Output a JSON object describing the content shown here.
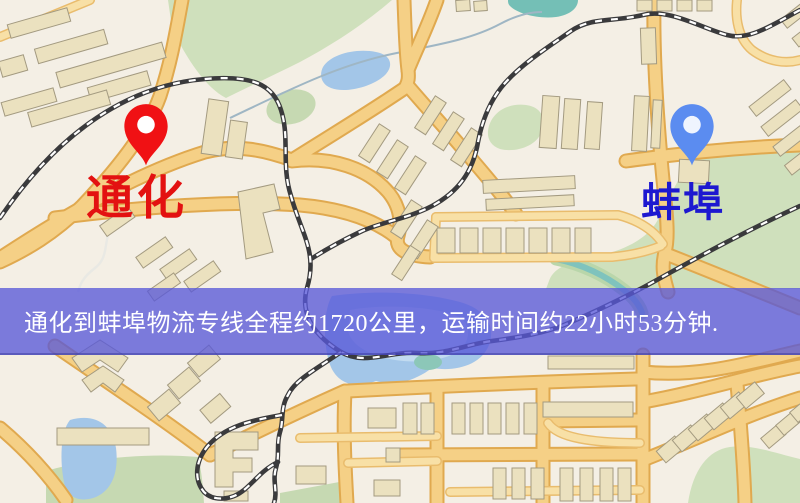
{
  "banner": {
    "text": "通化到蚌埠物流专线全程约1720公里，运输时间约22小时53分钟.",
    "background_color": "#5858d8",
    "text_color": "#ffffff"
  },
  "markers": [
    {
      "id": "origin",
      "city": "通化",
      "pin_color": "#f01114",
      "label_color": "#e31111"
    },
    {
      "id": "destination",
      "city": "蚌埠",
      "pin_color": "#5b8cf0",
      "label_color": "#1d18d0"
    }
  ],
  "route": {
    "origin_city": "通化",
    "destination_city": "蚌埠",
    "distance_text": "约1720公里",
    "duration_text": "约22小时53分钟"
  },
  "map_palette": {
    "background": "#f4efe5",
    "road_fill": "#f5d086",
    "road_edge": "#e0a94f",
    "railway": "#3a3a3c",
    "railway_dash": "#ffffff",
    "water": "#a3c6e8",
    "pond_teal": "#74bfb6",
    "greenspace": "#cfe0bc",
    "building_fill": "#ebe1bf",
    "building_stroke": "#a39a80"
  }
}
